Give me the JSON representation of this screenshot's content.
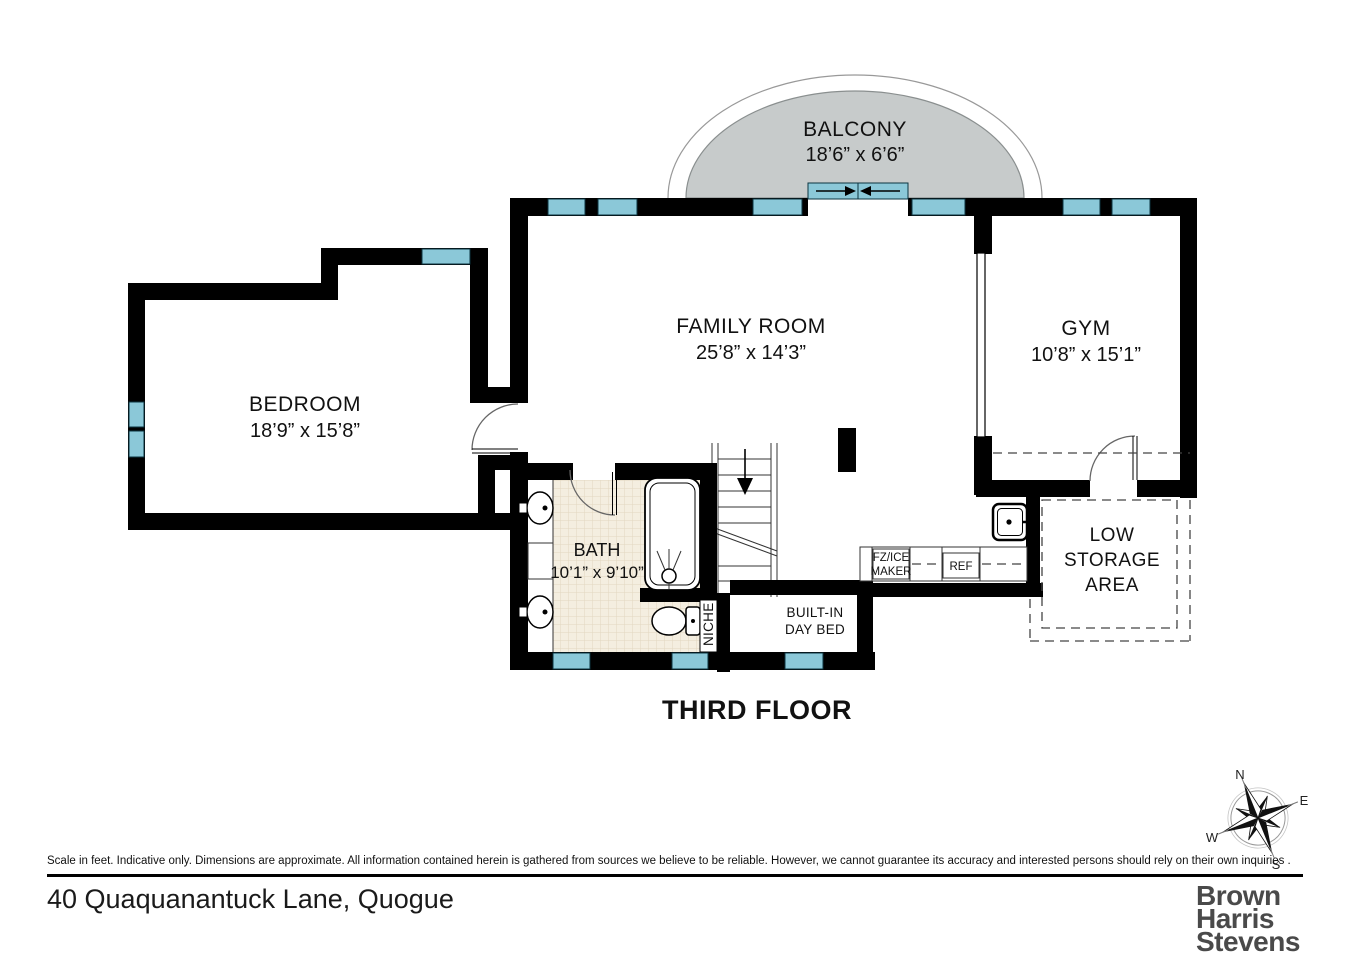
{
  "plan": {
    "title": "THIRD FLOOR",
    "rooms": {
      "balcony": {
        "name": "BALCONY",
        "dims": "18’6” x 6’6”"
      },
      "family_room": {
        "name": "FAMILY ROOM",
        "dims": "25’8” x 14’3”"
      },
      "gym": {
        "name": "GYM",
        "dims": "10’8” x 15’1”"
      },
      "bedroom": {
        "name": "BEDROOM",
        "dims": "18’9” x 15’8”"
      },
      "bath": {
        "name": "BATH",
        "dims": "10’1” x 9’10”"
      }
    },
    "labels": {
      "niche": "NICHE",
      "day_bed": [
        "BUILT-IN",
        "DAY BED"
      ],
      "fz_ice": [
        "FZ/ICE",
        "MAKER"
      ],
      "ref": "REF",
      "low_storage": [
        "LOW",
        "STORAGE",
        "AREA"
      ]
    },
    "compass": {
      "n": "N",
      "e": "E",
      "s": "S",
      "w": "W"
    }
  },
  "footer": {
    "disclaimer": "Scale in feet. Indicative only. Dimensions are approximate. All information contained herein is gathered from sources we believe to be reliable. However, we cannot guarantee its accuracy and interested persons should rely on their own inquiries .",
    "address": "40 Quaquanantuck Lane, Quogue",
    "brand": [
      "Brown",
      "Harris",
      "Stevens"
    ]
  },
  "colors": {
    "wall": "#000000",
    "window": "#8bc8d8",
    "balcony_fill": "#c7cbcb",
    "tile": "#f4eee0",
    "tile_line": "#e2d7c0",
    "brand_text": "#4a4a4a"
  }
}
